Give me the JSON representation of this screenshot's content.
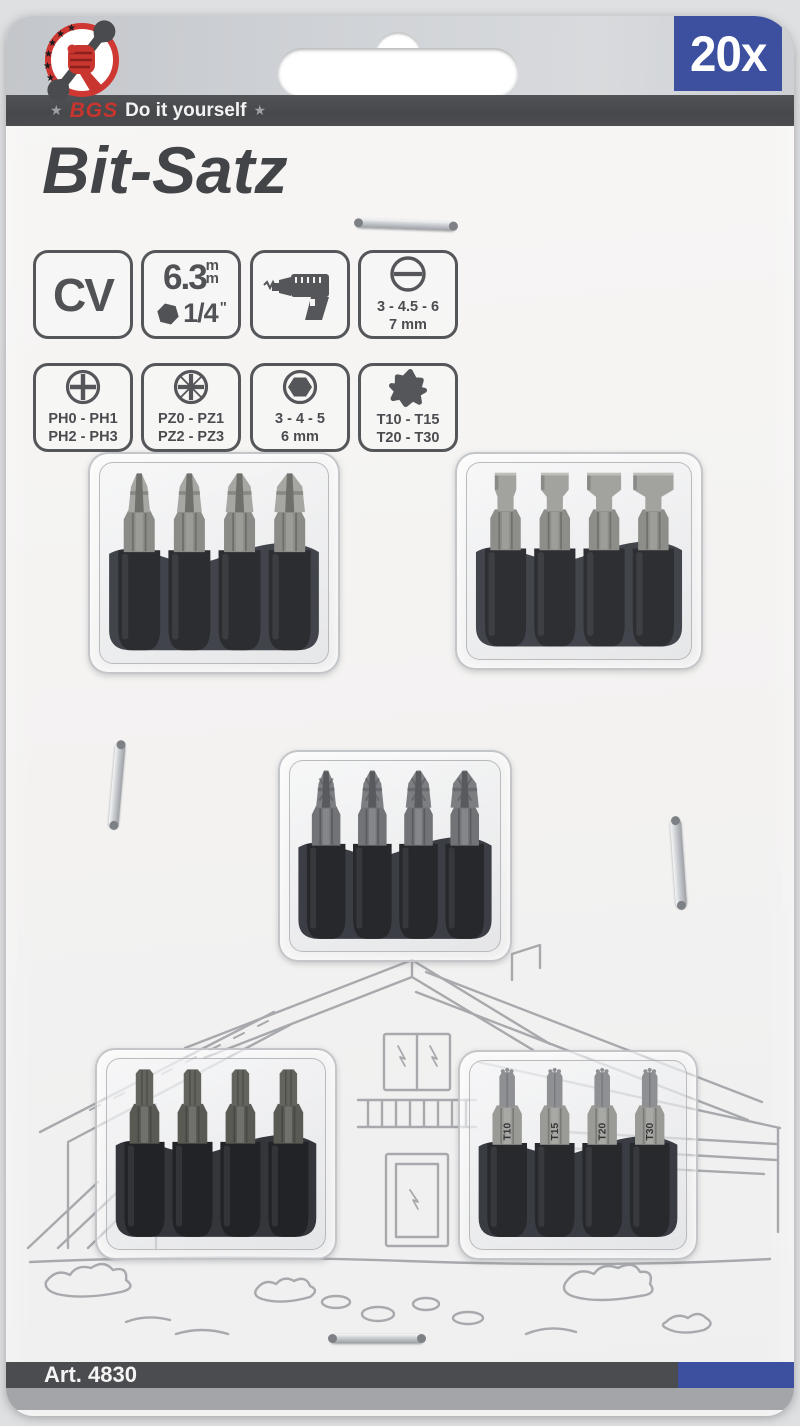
{
  "card": {
    "badge_count": "20x",
    "brand": {
      "star_left": "★",
      "name": "BGS",
      "tagline": "Do it yourself",
      "star_right": "★"
    },
    "title": "Bit-Satz",
    "article": "Art. 4830"
  },
  "specs": {
    "cv": {
      "label": "CV"
    },
    "drive": {
      "size": "6.3",
      "m1": "m",
      "m2": "m",
      "inch": "1/4",
      "mark": "\""
    },
    "machine": {
      "icon": "drill-icon"
    },
    "slotted": {
      "line1": "3 - 4.5 - 6",
      "line2": "7 mm"
    },
    "phillips": {
      "line1": "PH0 - PH1",
      "line2": "PH2 - PH3"
    },
    "pozidriv": {
      "line1": "PZ0 - PZ1",
      "line2": "PZ2 - PZ3"
    },
    "hex": {
      "line1": "3 - 4 - 5",
      "line2": "6 mm"
    },
    "torx": {
      "line1": "T10 - T15",
      "line2": "T20 - T30"
    }
  },
  "blisters": [
    {
      "name": "phillips-bits",
      "type": "ph",
      "count": 4
    },
    {
      "name": "slotted-bits",
      "type": "sl",
      "count": 4
    },
    {
      "name": "pozidriv-bits",
      "type": "pz",
      "count": 4
    },
    {
      "name": "hex-bits",
      "type": "hex",
      "count": 4
    },
    {
      "name": "torx-bits",
      "type": "tx",
      "count": 4,
      "markings": [
        "T10",
        "T15",
        "T20",
        "T30"
      ]
    }
  ],
  "colors": {
    "badge_blue": "#3d50a0",
    "stripe_dark": "#4b4c4f",
    "brand_red": "#c9352e",
    "title_gray": "#434447"
  }
}
